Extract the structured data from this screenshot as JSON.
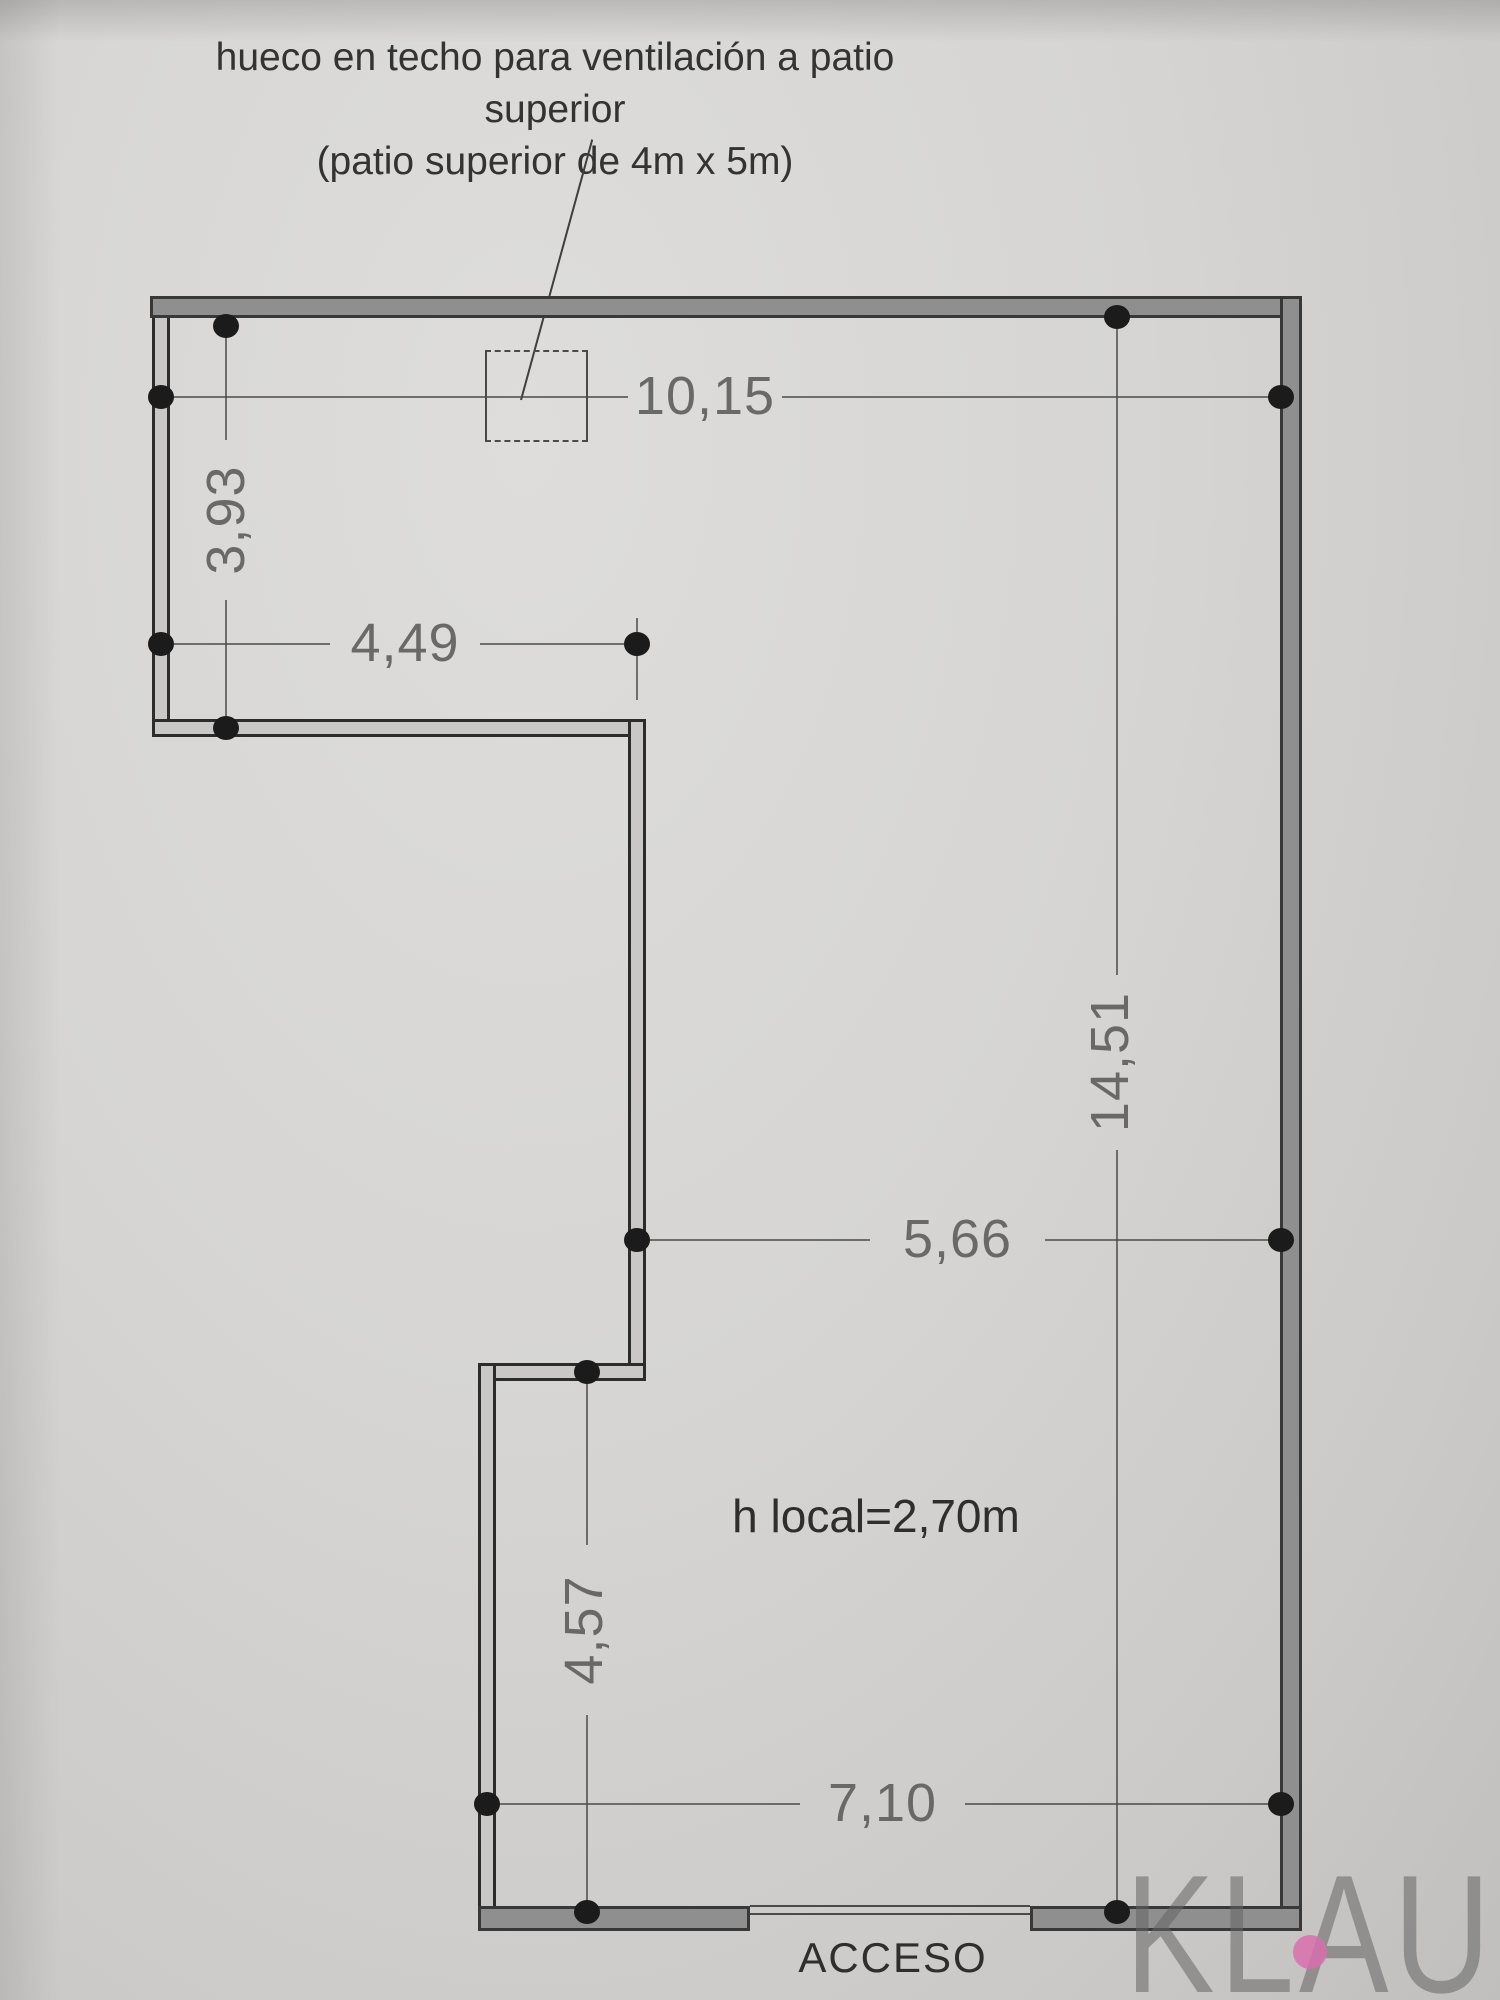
{
  "annotation": {
    "line1": "hueco en techo para ventilación a patio superior",
    "line2": "(patio superior de 4m x 5m)"
  },
  "dimensions": {
    "top_width": "10,15",
    "upper_left_height": "3,93",
    "upper_arm_width": "4,49",
    "mid_width": "5,66",
    "right_height": "14,51",
    "lower_left_height": "4,57",
    "bottom_width": "7,10"
  },
  "labels": {
    "room_height": "h local=2,70m",
    "entrance": "ACCESO"
  },
  "watermark": {
    "text": "KLAUS",
    "letter_color": "#9c9c9c",
    "dot_color": "#d96fae"
  },
  "colors": {
    "paper": "#d6d5d3",
    "exterior_wall_fill": "#8f8f8f",
    "interior_wall_fill": "#c9c8c6",
    "wall_edge": "#383838",
    "dim_line": "#4a4a4a",
    "dim_text": "#606060",
    "annotation_text": "#333333",
    "endpoint_dot": "#1b1b1b"
  }
}
